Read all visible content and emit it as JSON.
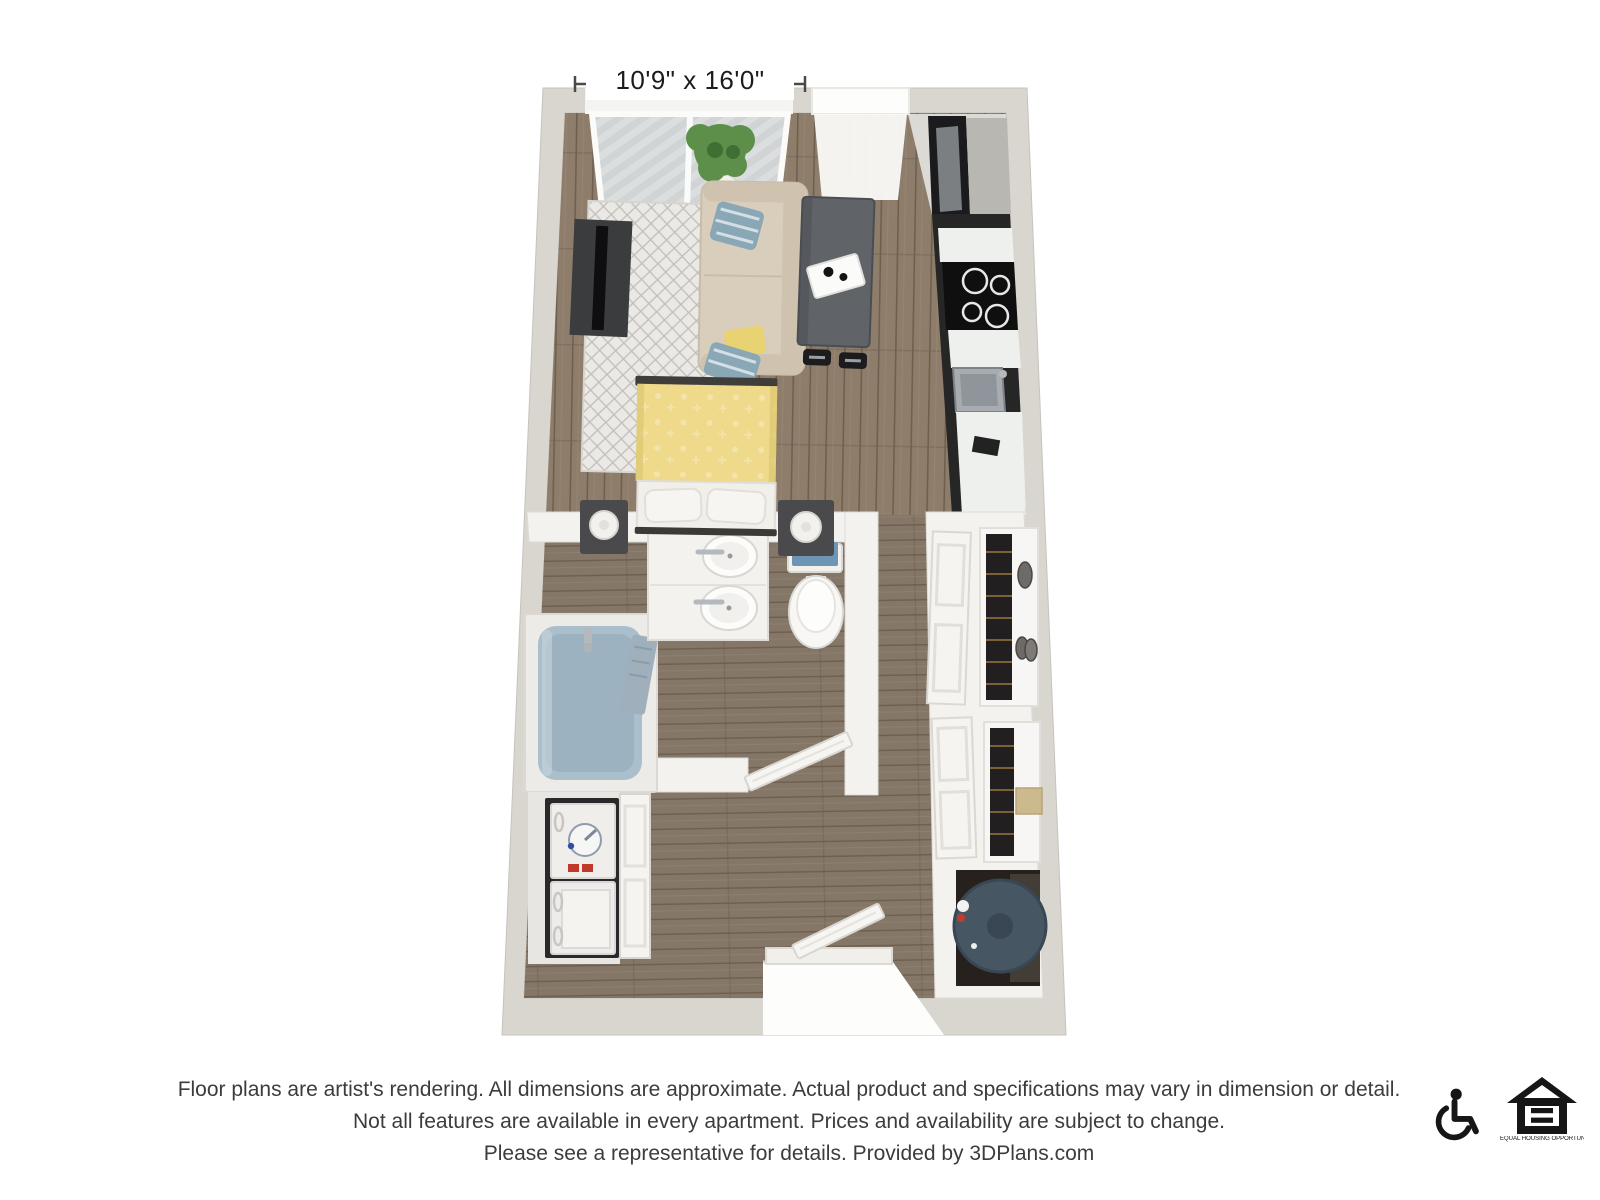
{
  "floor_plan": {
    "dimension_label": "10'9\" x 16'0\"",
    "rooms": [
      "living-area",
      "kitchen",
      "sleeping-area",
      "bathroom",
      "hallway",
      "laundry-closet",
      "wardrobe-closets",
      "water-heater-closet",
      "entry",
      "balcony"
    ]
  },
  "disclaimer": {
    "lines": [
      "Floor plans are artist's rendering. All dimensions are approximate. Actual product and specifications may vary in dimension or detail.",
      "Not all features are available in every apartment. Prices and availability are subject to change.",
      "Please see a representative for details. Provided by 3DPlans.com"
    ]
  },
  "footer_icons": [
    {
      "name": "wheelchair-accessible-icon"
    },
    {
      "name": "equal-housing-opportunity-icon",
      "caption": "EQUAL HOUSING OPPORTUNITY"
    }
  ],
  "colors": {
    "bg": "#ffffff",
    "wall": "#d9d6d0",
    "wall-edge": "#c6c3bc",
    "partition": "#f3f2ef",
    "partition-edge": "#dedbd5",
    "floor": "#8e7d6a",
    "floor-dark": "#6f5f4f",
    "floor-light": "#a3917e",
    "floor-gray": "#857768",
    "rug": "#ebe9e5",
    "rug-pattern": "#c2bfba",
    "couch": "#d9cdbb",
    "couch-shade": "#cfc2ae",
    "pillow-blue": "#8aa7b5",
    "pillow-yellow": "#e8d272",
    "island": "#606468",
    "island-dark": "#4a4e52",
    "tv": "#3b3c3e",
    "bed-yellow": "#eeda8a",
    "bed-white": "#f1efea",
    "nightstand": "#4a4a4c",
    "fixture-white": "#f8f7f5",
    "tub-fill": "#aabfcc",
    "tub-deep": "#90a8b8",
    "towel-blue": "#6e96b4",
    "chrome": "#b4b9bd",
    "cabinet-dark": "#262626",
    "counter": "#eef0ee",
    "cooktop": "#0f0f0f",
    "steel": "#9aa0a4",
    "clothes": "#211f20",
    "heater": "#475663",
    "glass": "#e8eef0",
    "deck": "#d4d6d6",
    "deck-stripe": "#c3c6c6",
    "plant": "#5d8f4a",
    "plant-dark": "#3f7033",
    "label-text": "#1c1c1c",
    "disclaimer-text": "#3c3c3c",
    "icon-black": "#161616",
    "accent-red": "#c0392b",
    "accent-blue": "#2e4fa3"
  }
}
